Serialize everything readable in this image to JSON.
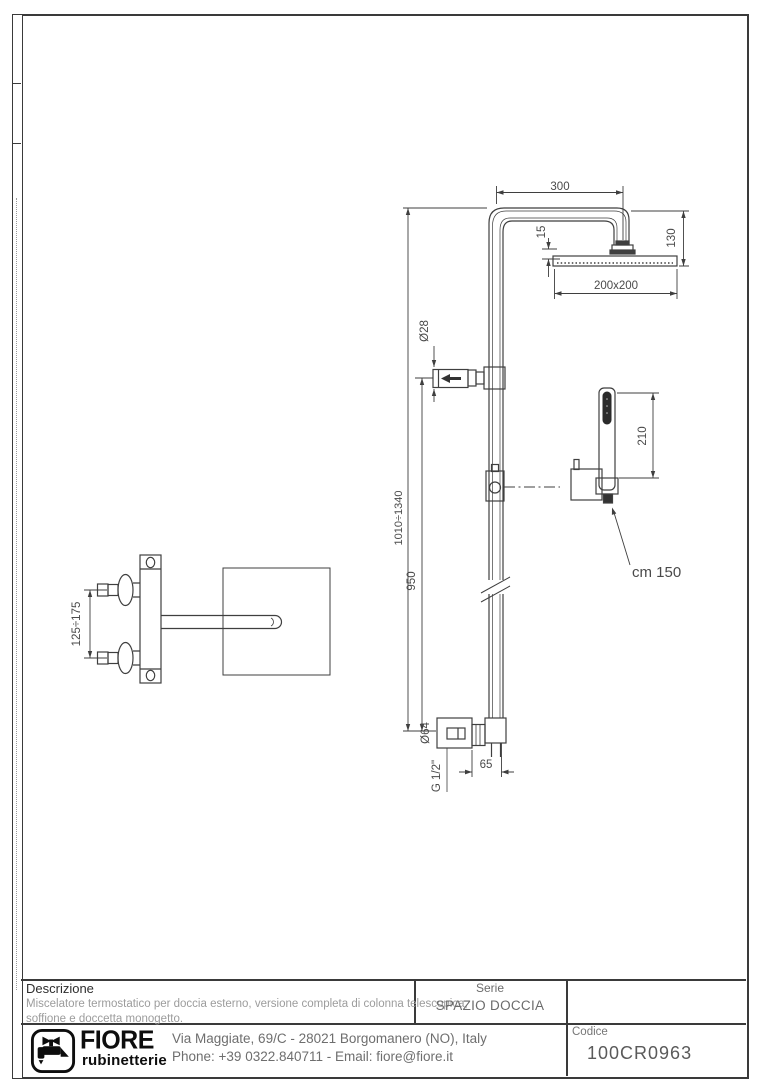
{
  "colors": {
    "line": "#3f3f3f",
    "dim_text": "#4a4a4a",
    "desc_text": "#9c9c9c",
    "frame": "#3a3a3a"
  },
  "drawing": {
    "dims": {
      "arm_length": "300",
      "head_drop": "130",
      "head_inset": "15",
      "head_size": "200x200",
      "knob_diameter": "Ø28",
      "handshower_length": "210",
      "column_height_range": "1010÷1340",
      "lower_column_height": "950",
      "hose_length": "cm 150",
      "valve_spacing": "125÷175",
      "flange_diameter": "Ø64",
      "wall_offset": "65",
      "thread_size": "G 1/2\""
    }
  },
  "title_block": {
    "description_label": "Descrizione",
    "description_line1": "Miscelatore termostatico per doccia esterno, versione completa di colonna telescopica,",
    "description_line2": "soffione e doccetta monogetto.",
    "series_label": "Serie",
    "series_value": "SPAZIO DOCCIA",
    "code_label": "Codice",
    "code_value": "100CR0963",
    "brand_name": "FIORE",
    "brand_sub": "rubinetterie",
    "address": "Via Maggiate, 69/C - 28021 Borgomanero (NO), Italy",
    "contact": "Phone: +39 0322.840711 - Email: fiore@fiore.it"
  }
}
